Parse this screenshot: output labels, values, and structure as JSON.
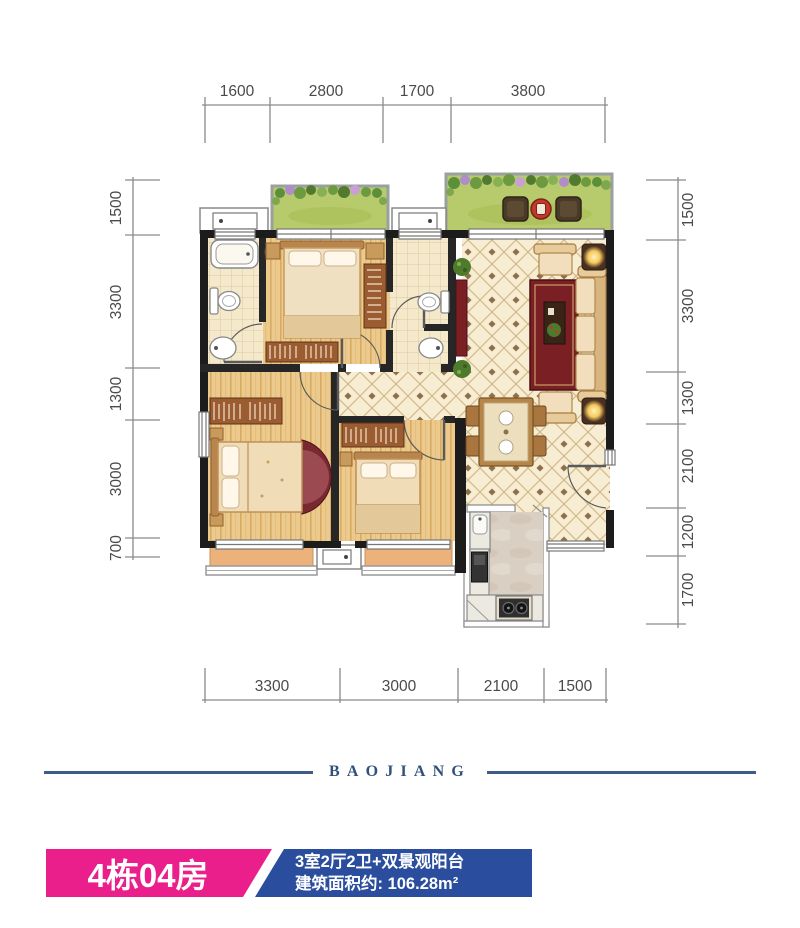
{
  "plan": {
    "dimensions": {
      "top": [
        "1600",
        "2800",
        "1700",
        "3800"
      ],
      "left": [
        "1500",
        "3300",
        "1300",
        "3000",
        "700"
      ],
      "right": [
        "1500",
        "3300",
        "1300",
        "2100",
        "1200",
        "1700"
      ],
      "bottom": [
        "3300",
        "3000",
        "2100",
        "1500"
      ]
    }
  },
  "brand": {
    "name": "BAOJIANG"
  },
  "unit_card": {
    "unit_name": "4栋04房",
    "layout_desc": "3室2厅2卫+双景观阳台",
    "area_desc": "建筑面积约: 106.28m²"
  },
  "colors": {
    "unit_badge_pink": "#ea1f8b",
    "info_badge_blue": "#2b4d9d",
    "brand_blue": "#31517c",
    "wall_dark": "#1c1c1c",
    "wood_floor": "#ecca8e",
    "tile_floor": "#f6edd3",
    "bath_floor": "#f5e9cb",
    "balcony_green": "#b7cb6d",
    "balcony_orange": "#edb27c",
    "dimension_text": "#4a4a4a"
  }
}
